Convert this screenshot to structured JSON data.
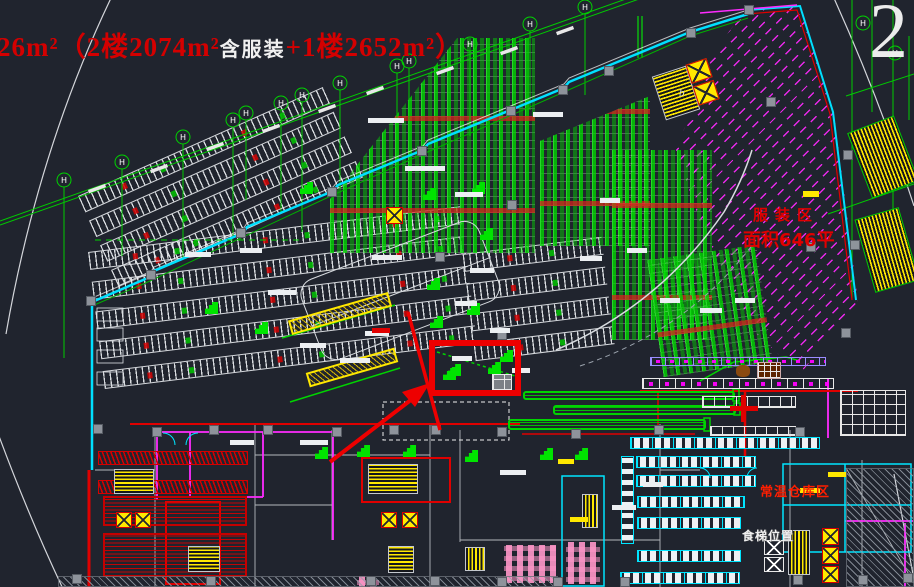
{
  "sheet": {
    "number": "2"
  },
  "note": {
    "red_prefix": "26m²（2楼2074m²",
    "white_middle": "含服装",
    "red_suffix": "+1楼2652m²）"
  },
  "zones": {
    "clothing": {
      "name": "服装区",
      "area": "面积646平"
    },
    "warehouse": {
      "name": "常温仓库区"
    },
    "food_lift": {
      "name": "食梯位置"
    },
    "stair": {
      "label": "b"
    }
  },
  "grid": {
    "bubble": "H"
  },
  "colors": {
    "background": "#20242e",
    "line_green": "#00d400",
    "line_cyan": "#00e5ff",
    "line_magenta": "#ff00ff",
    "line_red": "#e00000",
    "line_yellow": "#ffe800",
    "annotation_red": "#d40000",
    "text_white": "#f0f0f0"
  }
}
